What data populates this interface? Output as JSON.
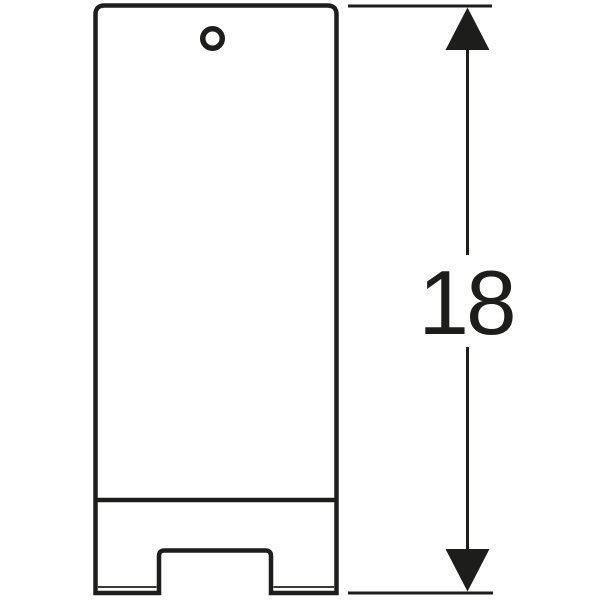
{
  "diagram": {
    "type": "technical-drawing",
    "dimension": {
      "label": "18"
    },
    "colors": {
      "line": "#1d1d1b",
      "background": "#ffffff"
    }
  }
}
